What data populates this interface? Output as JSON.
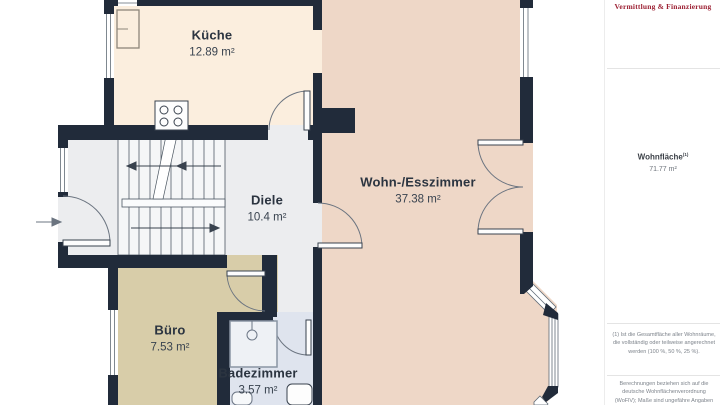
{
  "sidebar": {
    "logo_text": "Vermittlung & Finanzierung",
    "living_area": {
      "label": "Wohnfläche",
      "footnote_marker": "(1)",
      "value": "71.77 m²"
    },
    "footnotes": {
      "area_definition": "(1) Ist die Gesamtfläche aller Wohnräume, die vollständig oder teilweise angerechnet werden (100 %, 50 %, 25 %).",
      "calculation": "Berechnungen beziehen sich auf die deutsche Wohnflächenverordnung (WoFlV); Maße sind ungefähre Angaben"
    }
  },
  "floorplan": {
    "rooms": {
      "kueche": {
        "name": "Küche",
        "area": "12.89 m²"
      },
      "wohn_esszimmer": {
        "name": "Wohn-/Esszimmer",
        "area": "37.38 m²"
      },
      "diele": {
        "name": "Diele",
        "area": "10.4 m²"
      },
      "buero": {
        "name": "Büro",
        "area": "7.53 m²"
      },
      "badezimmer": {
        "name": "Badezimmer",
        "area": "3.57 m²"
      }
    },
    "colors": {
      "wall": "#212b3a",
      "kueche_floor": "#fbeede",
      "wohnzimmer_floor": "#eed7c7",
      "diele_floor": "#ecedef",
      "buero_floor": "#d8cda9",
      "badezimmer_floor": "#dfe4ee",
      "logo_red": "#9c2033"
    }
  }
}
